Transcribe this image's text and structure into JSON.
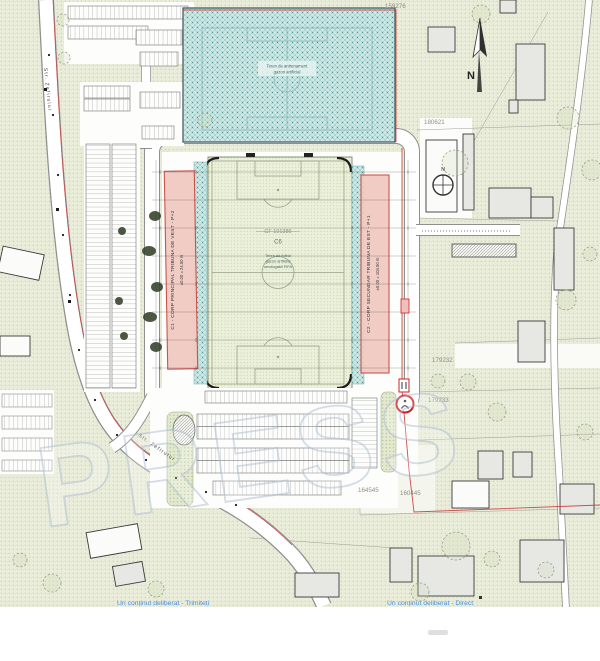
{
  "map": {
    "parcel_numbers": [
      "159276",
      "180621",
      "179232",
      "179233",
      "164545",
      "160445"
    ],
    "north_label": "N",
    "compass_label": "N"
  },
  "stadium": {
    "field": {
      "cf": "CF 191386",
      "building_code": "C6",
      "line1": "Teren de fotbal",
      "line2": "gazon artificial",
      "line3": "omologabil FIFA"
    },
    "tribune_west": {
      "label": "C1 - CORP PRINCIPAL TRIBUNA DE VEST - P+2",
      "elevation": "±0.00 = 24.50 m"
    },
    "tribune_east": {
      "label": "C2 - CORP SECUNDAR TRIBUNA DE EST - P+1",
      "elevation": "±0.00 = 104.50 m"
    }
  },
  "training_field": {
    "line1": "Teren de antrenament",
    "line2": "gazon artificial"
  },
  "streets": {
    "west": "Str. Zefirului",
    "south": "Str. Zefirului"
  },
  "watermark": "PRESS",
  "footer": {
    "left_link": "Un conținut deliberat - Trimiteți",
    "right_link": "Un conținut deliberat - Direct"
  },
  "colors": {
    "site_boundary": "#cf3a3a",
    "tribune_fill": "#f1cac3",
    "tribune_stroke": "#c84b42",
    "training_fill": "#cde7e5",
    "parcel_fill": "#e9ecd9",
    "link_blue": "#4a90e2",
    "watermark_stroke": "#b4c2d4"
  }
}
